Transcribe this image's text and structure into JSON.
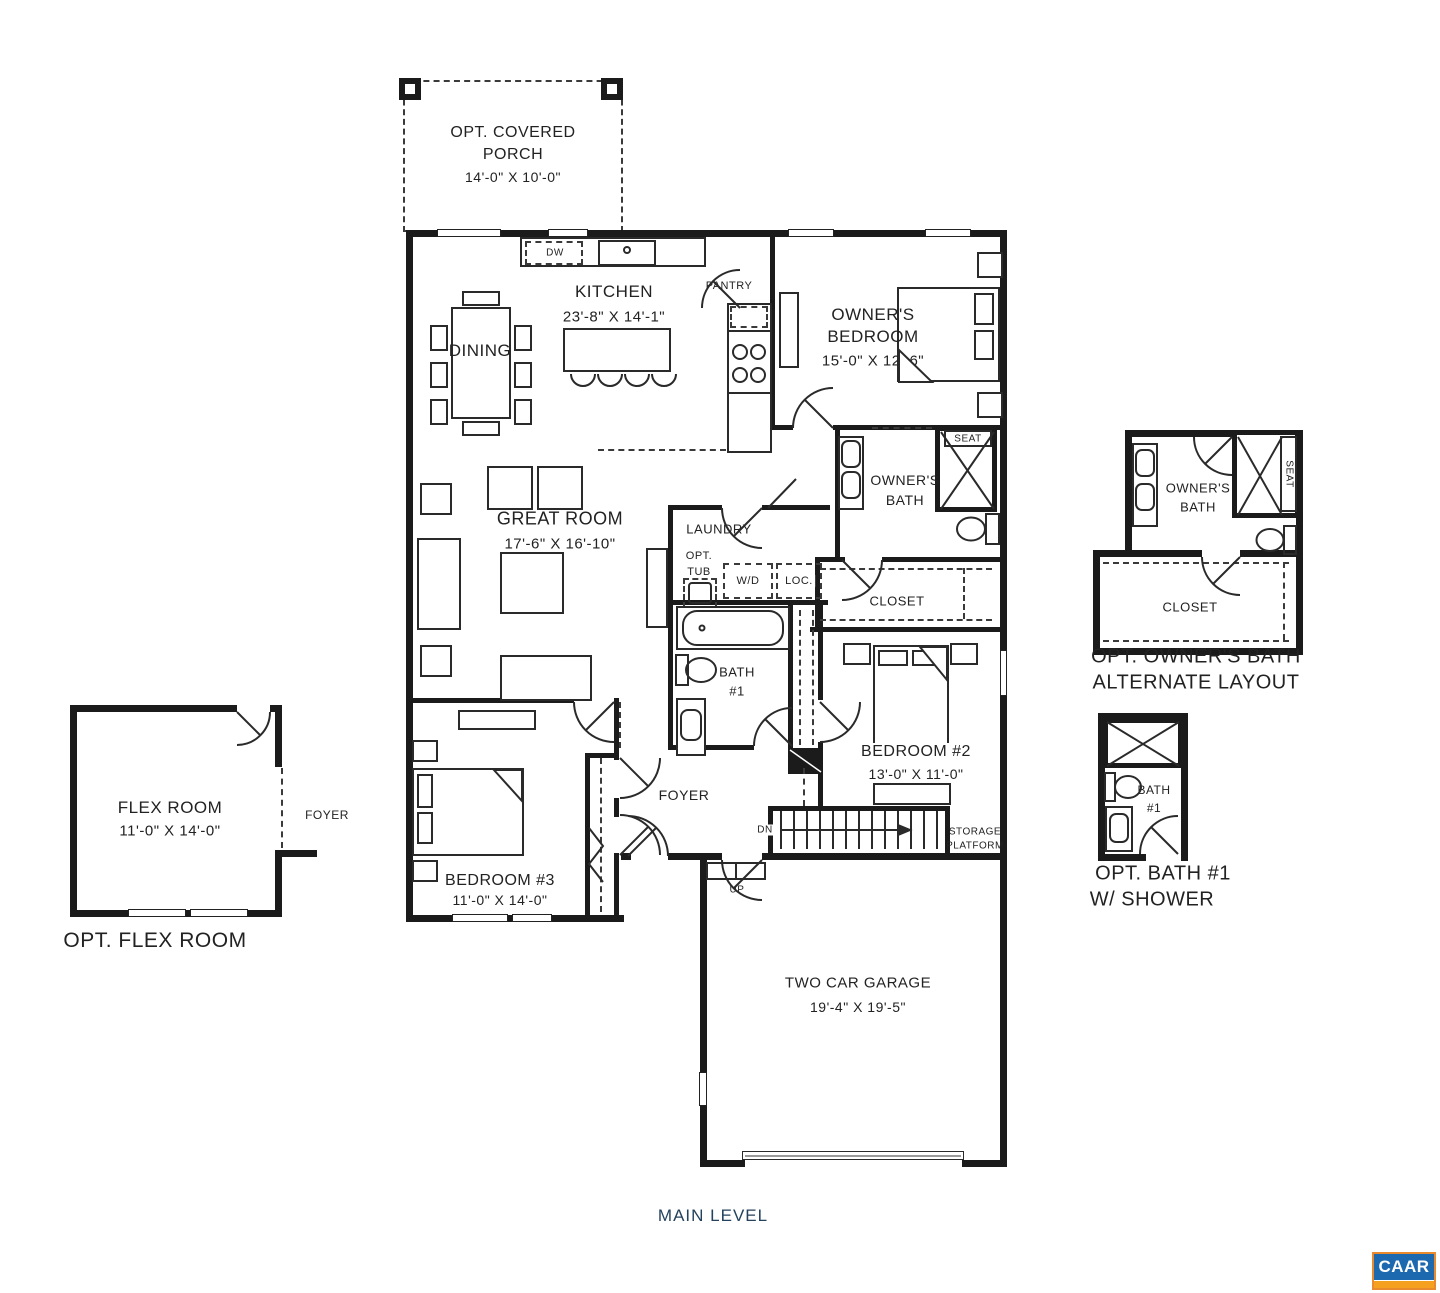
{
  "rooms": {
    "porch": {
      "l1": "OPT. COVERED",
      "l2": "PORCH",
      "dims": "14'-0\" X 10'-0\""
    },
    "kitchen": {
      "name": "KITCHEN",
      "dims": "23'-8\" X 14'-1\"",
      "dw": "DW"
    },
    "dining": {
      "name": "DINING"
    },
    "pantry": {
      "name": "PANTRY"
    },
    "owners_bedroom": {
      "l1": "OWNER'S",
      "l2": "BEDROOM",
      "dims": "15'-0\" X 12'-6\""
    },
    "owners_bath": {
      "l1": "OWNER'S",
      "l2": "BATH",
      "seat": "SEAT"
    },
    "laundry": {
      "name": "LAUNDRY",
      "opt1": "OPT.",
      "opt2": "TUB",
      "wd": "W/D",
      "loc": "LOC."
    },
    "closet": {
      "name": "CLOSET"
    },
    "great_room": {
      "name": "GREAT ROOM",
      "dims": "17'-6\" X 16'-10\""
    },
    "bath1": {
      "l1": "BATH",
      "l2": "#1"
    },
    "bedroom2": {
      "name": "BEDROOM #2",
      "dims": "13'-0\" X 11'-0\""
    },
    "foyer": {
      "name": "FOYER"
    },
    "stairs": {
      "dn": "DN",
      "up": "UP"
    },
    "storage": {
      "l1": "STORAGE",
      "l2": "PLATFORM"
    },
    "bedroom3": {
      "name": "BEDROOM #3",
      "dims": "11'-0\" X 14'-0\""
    },
    "garage": {
      "name": "TWO CAR GARAGE",
      "dims": "19'-4\" X 19'-5\""
    }
  },
  "flex_inset": {
    "name": "FLEX ROOM",
    "dims": "11'-0\" X 14'-0\"",
    "foyer": "FOYER",
    "caption": "OPT. FLEX ROOM"
  },
  "owners_bath_inset": {
    "l1": "OWNER'S",
    "l2": "BATH",
    "seat": "SEAT",
    "closet": "CLOSET",
    "cap1": "OPT. OWNER'S BATH",
    "cap2": "ALTERNATE LAYOUT"
  },
  "bath1_inset": {
    "l1": "BATH",
    "l2": "#1",
    "cap1": "OPT. BATH #1",
    "cap2": "W/ SHOWER"
  },
  "footer": {
    "level": "MAIN LEVEL"
  },
  "logo": {
    "text": "CAAR"
  },
  "colors": {
    "navy": "#24425c",
    "logo_blue": "#1c69b0",
    "logo_orange": "#f5a01e",
    "line": "#1b1b1b"
  }
}
